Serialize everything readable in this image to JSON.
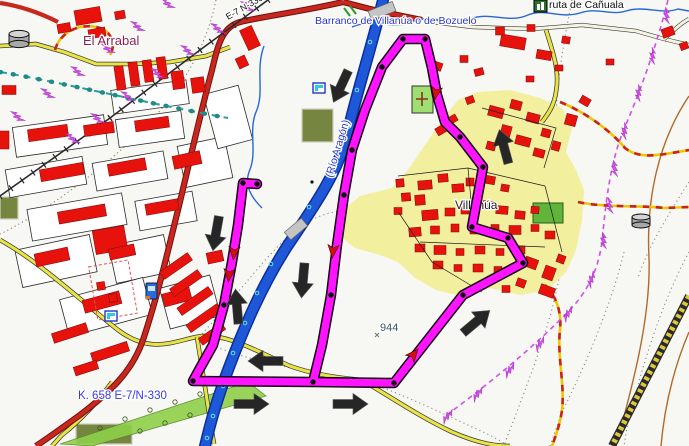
{
  "map": {
    "labels": {
      "settlement_nw": "El Arrabal",
      "stream": "Barranco de Villanúa o de Bozuelo",
      "poi_top_right": "ruta de Cañuala",
      "road_top": "E-7 N-330",
      "village": "Villanúa",
      "river": "(Río Aragón)",
      "spot_height": "944",
      "km_marker": "K. 658 E-7/N-330"
    },
    "icons": [
      "water-tank-icon",
      "water-tank-icon",
      "fuel-station-icon",
      "flag-icon",
      "flag-icon",
      "cave-icon",
      "cemetery-cross-icon"
    ],
    "theme": {
      "track": "#ff14ff",
      "track_casing": "#140014",
      "road_major": "#c8271e",
      "road_minor_fill": "#e9e445",
      "river": "#1e57d8",
      "river_casing": "#0a2f9a",
      "village_area": "#f2ef9e",
      "building": "#e8120d",
      "label_water": "#2a35c8",
      "label_settlement": "#8d2050",
      "arrow": "#262626",
      "trail_red": "#cc2020",
      "trail_yellow": "#e8c800",
      "power_line": "#d050e8",
      "contour": "#b06a28",
      "field_green": "#76853f",
      "orchard_green": "#8fd04a",
      "park_green": "#5fb53a",
      "cemetery_green": "#9fdf72"
    },
    "track": {
      "waypoints": [
        [
          257,
          184
        ],
        [
          243,
          183
        ],
        [
          224,
          305
        ],
        [
          193,
          381
        ],
        [
          313,
          382
        ],
        [
          394,
          383
        ],
        [
          331,
          295
        ],
        [
          344,
          195
        ],
        [
          352,
          150
        ],
        [
          382,
          67
        ],
        [
          403,
          39
        ],
        [
          425,
          39
        ],
        [
          460,
          137
        ],
        [
          483,
          167
        ],
        [
          472,
          227
        ],
        [
          508,
          238
        ],
        [
          523,
          263
        ],
        [
          463,
          295
        ]
      ],
      "arrowheads": [
        [
          436,
          92,
          100
        ],
        [
          234,
          252,
          95
        ],
        [
          229,
          274,
          95
        ],
        [
          333,
          250,
          95
        ],
        [
          413,
          355,
          -50
        ]
      ]
    },
    "direction_arrows": [
      [
        341,
        86,
        115
      ],
      [
        216,
        233,
        100
      ],
      [
        303,
        280,
        95
      ],
      [
        237,
        307,
        265
      ],
      [
        266,
        361,
        180
      ],
      [
        251,
        404,
        0
      ],
      [
        350,
        404,
        0
      ],
      [
        476,
        322,
        -40
      ],
      [
        504,
        147,
        -105
      ]
    ],
    "street_blocks": [
      [
        60,
        136,
        92,
        30,
        -8
      ],
      [
        150,
        129,
        66,
        28,
        -8
      ],
      [
        46,
        177,
        78,
        28,
        -10
      ],
      [
        130,
        171,
        72,
        28,
        -10
      ],
      [
        205,
        162,
        48,
        42,
        -12
      ],
      [
        77,
        217,
        96,
        32,
        -10
      ],
      [
        166,
        211,
        58,
        30,
        -10
      ],
      [
        56,
        261,
        76,
        38,
        -12
      ],
      [
        140,
        259,
        56,
        38,
        -12
      ],
      [
        106,
        307,
        86,
        38,
        -15
      ],
      [
        190,
        302,
        52,
        42,
        -15
      ],
      [
        150,
        97,
        76,
        24,
        -8
      ],
      [
        228,
        117,
        36,
        56,
        -15
      ]
    ],
    "buildings": [
      [
        88,
        16,
        26,
        15,
        -10
      ],
      [
        64,
        28,
        13,
        9,
        -10
      ],
      [
        97,
        33,
        17,
        9,
        -10
      ],
      [
        120,
        15,
        10,
        8,
        -10
      ],
      [
        250,
        38,
        13,
        22,
        -25
      ],
      [
        242,
        62,
        10,
        11,
        -25
      ],
      [
        120,
        78,
        9,
        24,
        -8
      ],
      [
        134,
        74,
        9,
        24,
        -8
      ],
      [
        148,
        71,
        9,
        22,
        -8
      ],
      [
        162,
        68,
        9,
        22,
        -8
      ],
      [
        178,
        80,
        12,
        18,
        -8
      ],
      [
        198,
        85,
        13,
        15,
        -8
      ],
      [
        9,
        90,
        14,
        9,
        0
      ],
      [
        4,
        140,
        10,
        18,
        0
      ],
      [
        48,
        133,
        40,
        12,
        -8
      ],
      [
        99,
        129,
        30,
        11,
        -8
      ],
      [
        152,
        124,
        34,
        11,
        -8
      ],
      [
        62,
        172,
        44,
        12,
        -10
      ],
      [
        127,
        167,
        38,
        12,
        -10
      ],
      [
        187,
        160,
        28,
        13,
        -12
      ],
      [
        82,
        214,
        48,
        12,
        -10
      ],
      [
        162,
        207,
        33,
        11,
        -10
      ],
      [
        110,
        240,
        32,
        24,
        -10
      ],
      [
        52,
        257,
        34,
        13,
        -12
      ],
      [
        122,
        252,
        26,
        11,
        -12
      ],
      [
        215,
        257,
        16,
        11,
        -12
      ],
      [
        102,
        302,
        38,
        13,
        -15
      ],
      [
        177,
        297,
        28,
        13,
        -15
      ],
      [
        70,
        333,
        36,
        10,
        -18
      ],
      [
        110,
        352,
        38,
        10,
        -18
      ],
      [
        86,
        368,
        24,
        9,
        -18
      ],
      [
        176,
        266,
        34,
        9,
        -35
      ],
      [
        186,
        283,
        34,
        9,
        -35
      ],
      [
        195,
        301,
        38,
        9,
        -35
      ],
      [
        204,
        318,
        38,
        9,
        -35
      ],
      [
        212,
        334,
        28,
        8,
        -35
      ],
      [
        101,
        286,
        8,
        8,
        -10
      ],
      [
        113,
        298,
        8,
        8,
        -10
      ],
      [
        513,
        42,
        25,
        12,
        10
      ],
      [
        544,
        55,
        15,
        9,
        10
      ],
      [
        566,
        40,
        8,
        7,
        10
      ],
      [
        500,
        31,
        9,
        8,
        0
      ],
      [
        531,
        28,
        8,
        7,
        0
      ],
      [
        437,
        66,
        10,
        8,
        20
      ],
      [
        464,
        59,
        8,
        7,
        0
      ],
      [
        479,
        72,
        9,
        7,
        -15
      ],
      [
        530,
        79,
        8,
        6,
        0
      ],
      [
        559,
        68,
        8,
        6,
        0
      ],
      [
        585,
        101,
        10,
        8,
        30
      ],
      [
        571,
        120,
        11,
        11,
        15
      ],
      [
        610,
        62,
        8,
        6,
        0
      ],
      [
        668,
        32,
        12,
        9,
        -20
      ],
      [
        684,
        46,
        8,
        7,
        -20
      ],
      [
        496,
        112,
        15,
        10,
        15
      ],
      [
        516,
        105,
        11,
        9,
        15
      ],
      [
        533,
        118,
        13,
        9,
        15
      ],
      [
        506,
        131,
        10,
        11,
        15
      ],
      [
        523,
        141,
        15,
        9,
        15
      ],
      [
        546,
        133,
        9,
        8,
        15
      ],
      [
        491,
        146,
        9,
        8,
        15
      ],
      [
        539,
        153,
        11,
        8,
        15
      ],
      [
        556,
        146,
        8,
        9,
        15
      ],
      [
        441,
        130,
        10,
        8,
        -30
      ],
      [
        453,
        119,
        8,
        7,
        -30
      ],
      [
        470,
        100,
        8,
        7,
        -20
      ],
      [
        425,
        185,
        14,
        9,
        -5
      ],
      [
        443,
        178,
        10,
        8,
        -5
      ],
      [
        458,
        188,
        12,
        8,
        -5
      ],
      [
        420,
        200,
        10,
        10,
        -5
      ],
      [
        470,
        182,
        8,
        8,
        0
      ],
      [
        490,
        180,
        10,
        8,
        10
      ],
      [
        505,
        188,
        8,
        7,
        10
      ],
      [
        430,
        215,
        16,
        10,
        -5
      ],
      [
        450,
        212,
        10,
        8,
        0
      ],
      [
        465,
        210,
        8,
        8,
        0
      ],
      [
        488,
        205,
        10,
        8,
        5
      ],
      [
        502,
        210,
        12,
        8,
        5
      ],
      [
        520,
        215,
        10,
        8,
        5
      ],
      [
        535,
        210,
        8,
        7,
        5
      ],
      [
        415,
        232,
        12,
        9,
        -5
      ],
      [
        435,
        230,
        9,
        8,
        0
      ],
      [
        455,
        228,
        8,
        8,
        0
      ],
      [
        475,
        230,
        10,
        8,
        0
      ],
      [
        495,
        228,
        8,
        7,
        0
      ],
      [
        515,
        230,
        12,
        9,
        0
      ],
      [
        535,
        228,
        8,
        7,
        0
      ],
      [
        550,
        235,
        10,
        8,
        0
      ],
      [
        420,
        248,
        10,
        8,
        0
      ],
      [
        440,
        250,
        12,
        9,
        0
      ],
      [
        460,
        252,
        8,
        7,
        0
      ],
      [
        480,
        250,
        10,
        8,
        0
      ],
      [
        500,
        252,
        8,
        7,
        0
      ],
      [
        520,
        250,
        10,
        8,
        0
      ],
      [
        438,
        265,
        10,
        8,
        0
      ],
      [
        458,
        268,
        8,
        7,
        0
      ],
      [
        478,
        268,
        10,
        8,
        0
      ],
      [
        498,
        270,
        8,
        7,
        0
      ],
      [
        400,
        183,
        8,
        8,
        -5
      ],
      [
        406,
        197,
        9,
        8,
        -5
      ],
      [
        398,
        211,
        8,
        7,
        0
      ],
      [
        531,
        263,
        13,
        10,
        20
      ],
      [
        549,
        273,
        11,
        13,
        20
      ],
      [
        561,
        259,
        8,
        8,
        20
      ],
      [
        521,
        283,
        9,
        8,
        20
      ],
      [
        506,
        289,
        8,
        7,
        0
      ],
      [
        547,
        291,
        15,
        10,
        20
      ]
    ],
    "power_bolts": [
      [
        245,
        8,
        -35
      ],
      [
        215,
        30,
        -35
      ],
      [
        185,
        52,
        -35
      ],
      [
        155,
        75,
        -35
      ],
      [
        125,
        98,
        -35
      ],
      [
        95,
        120,
        -35
      ],
      [
        70,
        140,
        -35
      ],
      [
        165,
        5,
        -35
      ],
      [
        135,
        28,
        -35
      ],
      [
        105,
        50,
        -35
      ],
      [
        75,
        73,
        -35
      ],
      [
        45,
        95,
        -35
      ],
      [
        15,
        118,
        -35
      ],
      [
        664,
        15,
        10
      ],
      [
        650,
        55,
        15
      ],
      [
        636,
        92,
        18
      ],
      [
        622,
        130,
        18
      ],
      [
        612,
        168,
        8
      ],
      [
        607,
        205,
        5
      ],
      [
        601,
        240,
        10
      ],
      [
        589,
        278,
        30
      ],
      [
        566,
        312,
        42
      ],
      [
        538,
        342,
        45
      ],
      [
        508,
        368,
        48
      ],
      [
        476,
        392,
        50
      ],
      [
        446,
        414,
        52
      ]
    ],
    "orchard_trees": [
      [
        100,
        428
      ],
      [
        125,
        419
      ],
      [
        150,
        410
      ],
      [
        175,
        402
      ],
      [
        200,
        394
      ],
      [
        225,
        387
      ],
      [
        140,
        431
      ],
      [
        165,
        423
      ],
      [
        190,
        415
      ],
      [
        215,
        407
      ]
    ],
    "river_marks": [
      [
        370,
        42
      ],
      [
        357,
        90
      ],
      [
        348,
        127
      ],
      [
        333,
        167
      ],
      [
        309,
        207
      ],
      [
        290,
        235
      ],
      [
        271,
        264
      ],
      [
        257,
        293
      ],
      [
        245,
        323
      ],
      [
        233,
        353
      ],
      [
        223,
        386
      ],
      [
        213,
        416
      ],
      [
        207,
        438
      ]
    ]
  }
}
